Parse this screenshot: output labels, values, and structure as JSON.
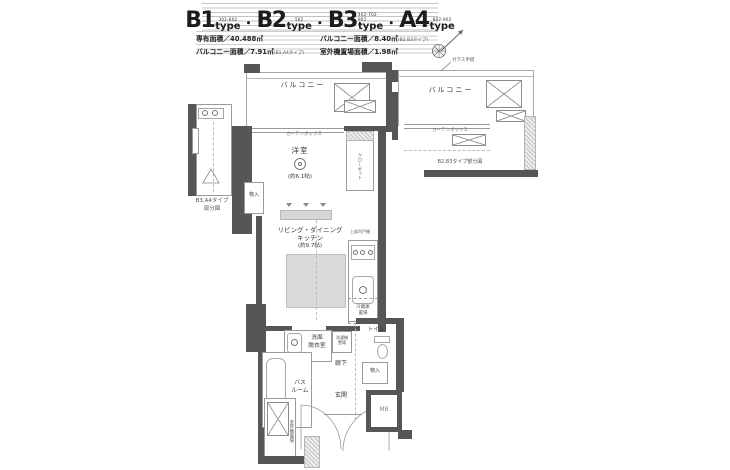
{
  "header": {
    "sep": "・",
    "types": [
      {
        "id": "B1",
        "type_word": "type",
        "units": "302-602"
      },
      {
        "id": "B2",
        "type_word": "type",
        "units": "502"
      },
      {
        "id": "B3",
        "type_word": "type",
        "units": "402-702-902"
      },
      {
        "id": "A4",
        "type_word": "type",
        "units": "802-902"
      }
    ],
    "specs": {
      "area_label": "専有面積／40.488㎡",
      "balcony2_label": "バルコニー面積／8.40㎡",
      "balcony2_note": "(B2,B3タイプ)",
      "balcony1_label": "バルコニー面積／7.91㎡",
      "balcony1_note": "(B1,A4タイプ)",
      "outdoor_label": "室外機置場面積／1.98㎡"
    }
  },
  "plan": {
    "balcony": "バルコニー",
    "glass_rail": "ガラス手摺",
    "curtain_box": "カーテンボックス",
    "western_room": "洋室",
    "western_room_size": "(約6.1帖)",
    "closet": "クローゼット",
    "storage": "物入",
    "ldk_line1": "リビング・ダイニング",
    "ldk_line2": "キッチン",
    "ldk_size": "(約9.7帖)",
    "upper_cabinet": "上部吊戸棚",
    "fridge_line1": "冷蔵庫",
    "fridge_line2": "置場",
    "washroom_line1": "洗面",
    "washroom_line2": "脱衣室",
    "washer_line1": "洗濯機",
    "washer_line2": "置場",
    "bath_line1": "バス",
    "bath_line2": "ルーム",
    "hallway": "廊下",
    "toilet": "トイレ",
    "entrance": "玄関",
    "meter_box": "MB",
    "outdoor_unit": "室外機置場",
    "left_caption_line1": "B3,A4タイプ",
    "left_caption_line2": "部分図",
    "right_caption": "B2,B3タイプ部分図"
  }
}
